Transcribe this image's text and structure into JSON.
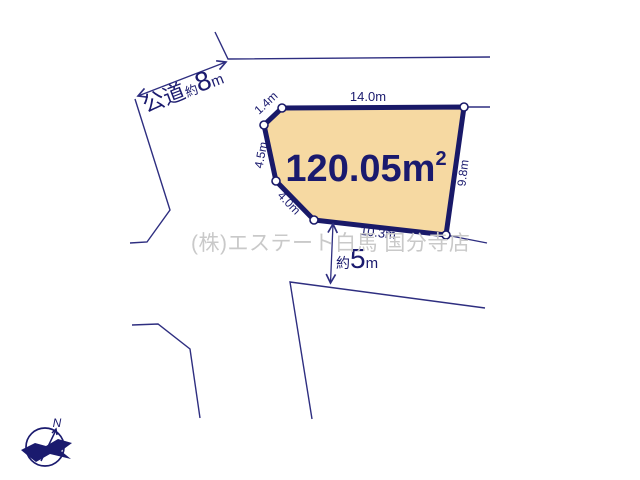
{
  "plot": {
    "area": {
      "value": "120.05",
      "unit": "m",
      "exponent": "2"
    },
    "fill_color": "#f6d9a2",
    "border_color": "#191968",
    "edge_labels": {
      "top": "14.0m",
      "upper_left": "1.4m",
      "left": "4.5m",
      "lower_left": "4.0m",
      "bottom": "10.3m",
      "right": "9.8m"
    }
  },
  "roads": {
    "public_road": {
      "name": "公道",
      "approx": "約",
      "value": "8",
      "unit": "m"
    },
    "south_road": {
      "approx": "約",
      "value": "5",
      "unit": "m"
    }
  },
  "watermark": {
    "text": "(株)エステート白馬 国分寺店",
    "color": "#c9c9c9"
  },
  "compass": {
    "north_label": "N"
  },
  "colors": {
    "line": "#2e2e80",
    "label": "#1a1a6e"
  }
}
